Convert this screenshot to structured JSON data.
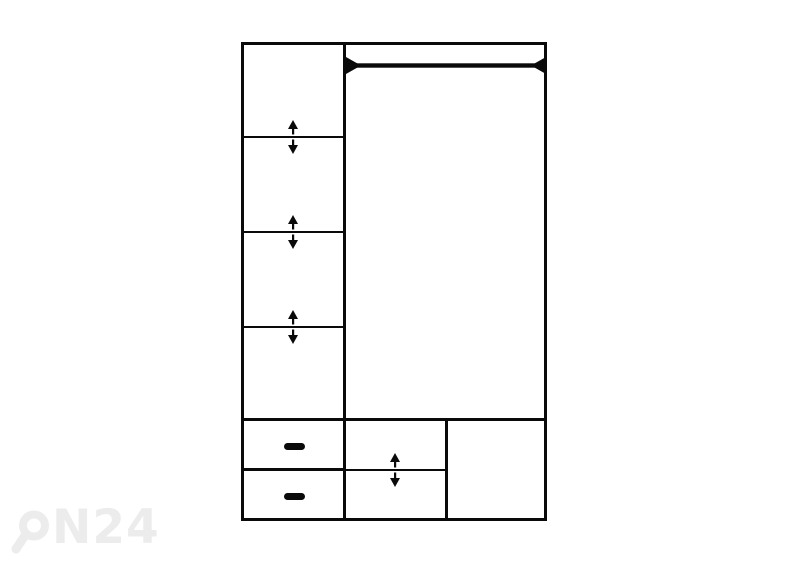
{
  "diagram": {
    "title": "wardrobe-interior-layout-schematic",
    "colors": {
      "line": "#0a0a0a",
      "background": "#ffffff",
      "watermark": "#ececec"
    },
    "left_column": {
      "compartments": 4,
      "adjustable_shelves": 3,
      "shelf_icon": "up-down-arrows"
    },
    "right_section": {
      "hanging_rails": 1,
      "rail_icon": "rod-with-end-mounts"
    },
    "bottom_row": {
      "drawers": 2,
      "drawer_handle_icon": "dash",
      "adjustable_shelves": 1,
      "open_compartments": 1
    },
    "watermark": {
      "full_text": "ON24",
      "text_after_logo": "N24",
      "logo_icon": "magnifier-o"
    }
  }
}
